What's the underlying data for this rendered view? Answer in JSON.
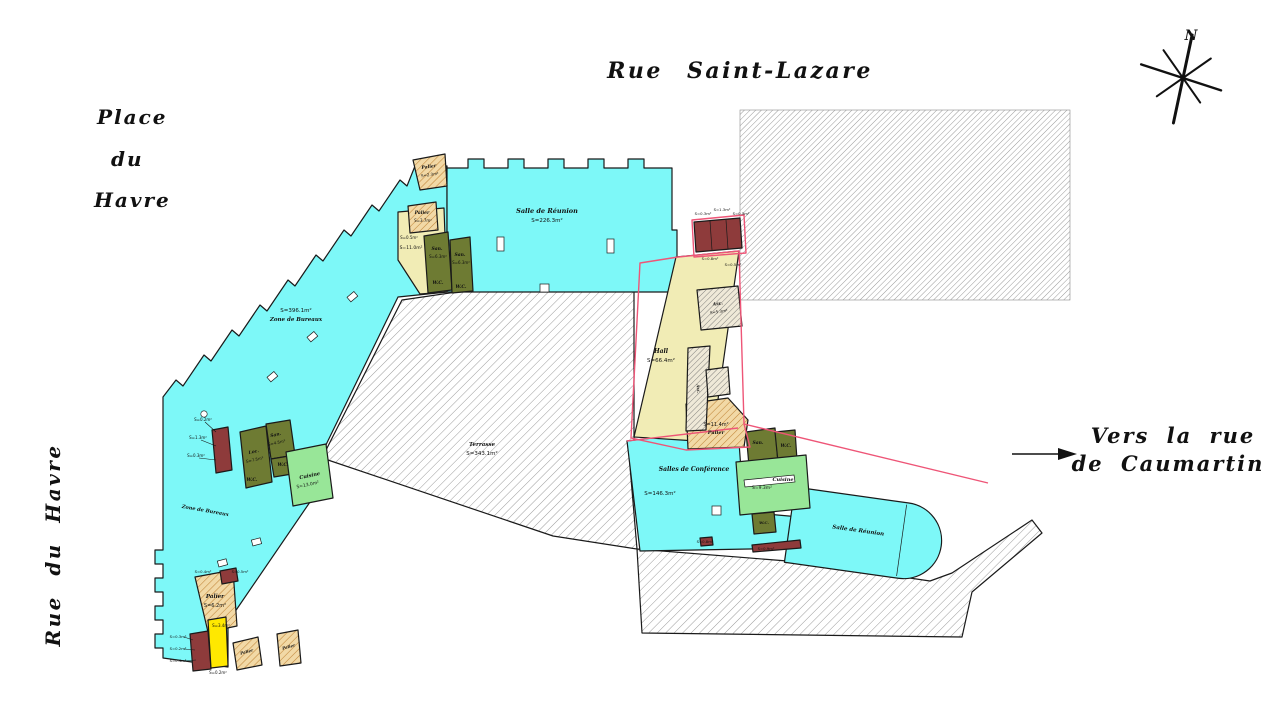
{
  "streets": {
    "top": "Rue Saint-Lazare",
    "place_line1": "Place",
    "place_line2": "du",
    "place_line3": "Havre",
    "left_vertical": "Rue du Havre",
    "right_line1": "Vers la rue",
    "right_line2": "de Caumartin"
  },
  "compass": {
    "north_label": "N"
  },
  "colors": {
    "floor_cyan": "#7df8f8",
    "hall_yellow": "#f1ecb5",
    "bright_yellow": "#ffe800",
    "olive_room": "#6e7b33",
    "light_green": "#98e698",
    "maroon": "#8e3b3b",
    "tan_hatch": "#f2d9a6",
    "tan_hatch_line": "#c08538",
    "gray_hatch_line": "#9b9b9b",
    "pink_boundary": "#ee5577",
    "line_black": "#1a1a1a"
  },
  "plan": {
    "labels": [
      {
        "text": "Salle de Réunion",
        "x": 547,
        "y": 213,
        "s": 6.5,
        "k": "name"
      },
      {
        "text": "S=226.3m²",
        "x": 547,
        "y": 222,
        "s": 5.5,
        "k": "area"
      },
      {
        "text": "S=396.1m²",
        "x": 296,
        "y": 312,
        "s": 5.5,
        "k": "area"
      },
      {
        "text": "Zone de Bureaux",
        "x": 296,
        "y": 321,
        "s": 5.5,
        "k": "name"
      },
      {
        "text": "Zone de Bureaux",
        "x": 205,
        "y": 512,
        "s": 5,
        "k": "name",
        "r": 10
      },
      {
        "text": "Terrasse",
        "x": 482,
        "y": 446,
        "s": 5.5,
        "k": "name"
      },
      {
        "text": "S=343.1m²",
        "x": 482,
        "y": 455,
        "s": 5.5,
        "k": "area"
      },
      {
        "text": "Hall",
        "x": 661,
        "y": 353,
        "s": 6,
        "k": "name"
      },
      {
        "text": "S=66.4m²",
        "x": 661,
        "y": 362,
        "s": 5.5,
        "k": "area"
      },
      {
        "text": "Salles de Conférence",
        "x": 694,
        "y": 471,
        "s": 6,
        "k": "name"
      },
      {
        "text": "S=146.3m²",
        "x": 660,
        "y": 495,
        "s": 5.5,
        "k": "area"
      },
      {
        "text": "Salle de Réunion",
        "x": 858,
        "y": 532,
        "s": 5.5,
        "k": "name",
        "r": 8
      },
      {
        "text": "S=11.4m²",
        "x": 716,
        "y": 426,
        "s": 5,
        "k": "area"
      },
      {
        "text": "Palier",
        "x": 716,
        "y": 434,
        "s": 5,
        "k": "name"
      },
      {
        "text": "Palier",
        "x": 215,
        "y": 598,
        "s": 5.5,
        "k": "name"
      },
      {
        "text": "S=6.2m²",
        "x": 215,
        "y": 607,
        "s": 5,
        "k": "area"
      },
      {
        "text": "Cuisine",
        "x": 310,
        "y": 477,
        "s": 5,
        "k": "name",
        "r": -12
      },
      {
        "text": "S=13.0m²",
        "x": 308,
        "y": 486,
        "s": 4.5,
        "k": "area",
        "r": -12
      },
      {
        "text": "Cuisine",
        "x": 783,
        "y": 481,
        "s": 5,
        "k": "name"
      },
      {
        "text": "S=9.3m²",
        "x": 762,
        "y": 489,
        "s": 4.5,
        "k": "area"
      },
      {
        "text": "Palier",
        "x": 429,
        "y": 168,
        "s": 4.5,
        "k": "name",
        "r": -8
      },
      {
        "text": "S=2.3m²",
        "x": 430,
        "y": 176,
        "s": 4,
        "k": "area",
        "r": -8
      },
      {
        "text": "Palier",
        "x": 422,
        "y": 214,
        "s": 4.5,
        "k": "name"
      },
      {
        "text": "S=3.7m²",
        "x": 423,
        "y": 222,
        "s": 4,
        "k": "area"
      },
      {
        "text": "S=0.5m²",
        "x": 409,
        "y": 239,
        "s": 4,
        "k": "area"
      },
      {
        "text": "S=11.0m²",
        "x": 411,
        "y": 249,
        "s": 4.5,
        "k": "area"
      },
      {
        "text": "San.",
        "x": 437,
        "y": 250,
        "s": 4.5,
        "k": "name"
      },
      {
        "text": "S=6.3m²",
        "x": 438,
        "y": 258,
        "s": 4,
        "k": "area"
      },
      {
        "text": "W.C.",
        "x": 438,
        "y": 284,
        "s": 4.5,
        "k": "name"
      },
      {
        "text": "San.",
        "x": 460,
        "y": 256,
        "s": 4.5,
        "k": "name"
      },
      {
        "text": "S=6.3m²",
        "x": 461,
        "y": 264,
        "s": 4,
        "k": "area"
      },
      {
        "text": "W.C.",
        "x": 461,
        "y": 288,
        "s": 4.5,
        "k": "name"
      },
      {
        "text": "Loc.",
        "x": 254,
        "y": 453,
        "s": 4.5,
        "k": "name",
        "r": -12
      },
      {
        "text": "S=7.5m²",
        "x": 255,
        "y": 461,
        "s": 4,
        "k": "area",
        "r": -12
      },
      {
        "text": "San.",
        "x": 276,
        "y": 436,
        "s": 4.5,
        "k": "name",
        "r": -12
      },
      {
        "text": "S=4.5m²",
        "x": 277,
        "y": 444,
        "s": 4,
        "k": "area",
        "r": -12
      },
      {
        "text": "W.C.",
        "x": 252,
        "y": 481,
        "s": 4.5,
        "k": "name"
      },
      {
        "text": "W.C.",
        "x": 283,
        "y": 466,
        "s": 4.5,
        "k": "name"
      },
      {
        "text": "San.",
        "x": 758,
        "y": 444,
        "s": 4.5,
        "k": "name"
      },
      {
        "text": "W.C.",
        "x": 786,
        "y": 447,
        "s": 4.5,
        "k": "name"
      },
      {
        "text": "W.C.",
        "x": 764,
        "y": 524,
        "s": 4,
        "k": "name"
      },
      {
        "text": "Asc.",
        "x": 718,
        "y": 305,
        "s": 4.5,
        "k": "name",
        "r": -8
      },
      {
        "text": "S=5.3m²",
        "x": 719,
        "y": 313,
        "s": 4,
        "k": "area",
        "r": -8
      },
      {
        "text": "Asc.",
        "x": 697,
        "y": 389,
        "s": 4,
        "k": "name",
        "r": 85
      },
      {
        "text": "Palier",
        "x": 247,
        "y": 653,
        "s": 4,
        "k": "name",
        "r": -15
      },
      {
        "text": "Palier",
        "x": 289,
        "y": 648,
        "s": 4,
        "k": "name",
        "r": -15
      },
      {
        "text": "S=0.2m²",
        "x": 203,
        "y": 421,
        "s": 4,
        "k": "area"
      },
      {
        "text": "S=1.3m²",
        "x": 198,
        "y": 439,
        "s": 4,
        "k": "area"
      },
      {
        "text": "S=0.3m²",
        "x": 196,
        "y": 457,
        "s": 4,
        "k": "area"
      },
      {
        "text": "S=0.3m²",
        "x": 703,
        "y": 215,
        "s": 3.8,
        "k": "area"
      },
      {
        "text": "S=1.3m²",
        "x": 722,
        "y": 211,
        "s": 3.8,
        "k": "area"
      },
      {
        "text": "S=0.3m²",
        "x": 741,
        "y": 215,
        "s": 3.8,
        "k": "area"
      },
      {
        "text": "S=0.8m²",
        "x": 710,
        "y": 260,
        "s": 3.8,
        "k": "area"
      },
      {
        "text": "S=0.5m²",
        "x": 733,
        "y": 266,
        "s": 3.8,
        "k": "area"
      },
      {
        "text": "S=0.4m²",
        "x": 203,
        "y": 573,
        "s": 3.8,
        "k": "area"
      },
      {
        "text": "S=0.5m²",
        "x": 240,
        "y": 573,
        "s": 3.8,
        "k": "area"
      },
      {
        "text": "S=3.4m²",
        "x": 221,
        "y": 627,
        "s": 4,
        "k": "area"
      },
      {
        "text": "S=0.3m²",
        "x": 178,
        "y": 638,
        "s": 3.8,
        "k": "area"
      },
      {
        "text": "S=0.2m²",
        "x": 178,
        "y": 650,
        "s": 3.8,
        "k": "area"
      },
      {
        "text": "S=0.4m²",
        "x": 178,
        "y": 662,
        "s": 3.8,
        "k": "area"
      },
      {
        "text": "S=0.2m²",
        "x": 218,
        "y": 674,
        "s": 4,
        "k": "area"
      },
      {
        "text": "S=0.8m²",
        "x": 705,
        "y": 543,
        "s": 3.8,
        "k": "area"
      },
      {
        "text": "S=0.9m²",
        "x": 766,
        "y": 550,
        "s": 3.8,
        "k": "area"
      }
    ]
  }
}
